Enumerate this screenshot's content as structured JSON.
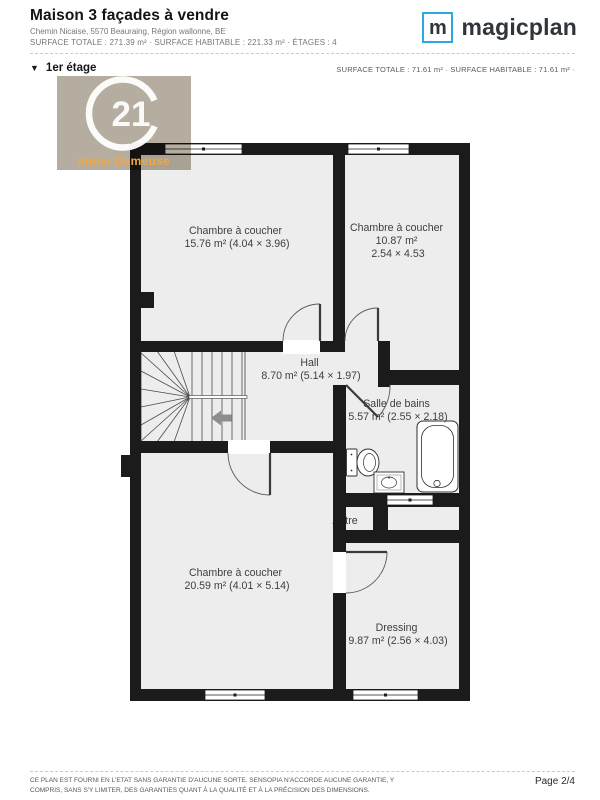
{
  "header": {
    "title": "Maison 3 façades à vendre",
    "address": "Chemin Nicaise, 5570 Beauraing, Région wallonne, BE",
    "surfaces": "SURFACE TOTALE : 271.39 m² · SURFACE HABITABLE : 221.33 m² · ÉTAGES : 4",
    "logo_letter": "m",
    "logo_text": "magicplan",
    "brand_color": "#2aaae1"
  },
  "section": {
    "collapse_icon": "▼",
    "floor": "1er étage",
    "surfaces": "SURFACE TOTALE : 71.61 m² · SURFACE HABITABLE : 71.61 m² ·"
  },
  "watermark": {
    "number": "21",
    "agency": "Immo Demeuse",
    "bg_color": "#b5ad9f",
    "text_color": "#f4a63f"
  },
  "rooms": {
    "bedroom_top_left": {
      "name": "Chambre à coucher",
      "area_dims": "15.76 m² (4.04 × 3.96)"
    },
    "bedroom_top_right": {
      "name": "Chambre à coucher",
      "area": "10.87 m²",
      "dims": "2.54 × 4.53"
    },
    "hall": {
      "name": "Hall",
      "area_dims": "8.70 m² (5.14 × 1.97)"
    },
    "bathroom": {
      "name": "Salle de bains",
      "area_dims": "5.57 m² (2.55 × 2.18)"
    },
    "bedroom_bottom_left": {
      "name": "Chambre à coucher",
      "area_dims": "20.59 m² (4.01 × 5.14)"
    },
    "dressing": {
      "name": "Dressing",
      "area_dims": "9.87 m² (2.56 × 4.03)"
    },
    "other": {
      "name": "Autre"
    }
  },
  "colors": {
    "wall": "#1b1b1b",
    "floor": "#ededed",
    "label": "#3e3e3e"
  },
  "footer": {
    "disclaimer1": "CE PLAN EST FOURNI EN L'ETAT SANS GARANTIE D'AUCUNE SORTE. SENSOPIA N'ACCORDE AUCUNE GARANTIE, Y",
    "disclaimer2": "COMPRIS, SANS S'Y LIMITER, DES GARANTIES QUANT À LA QUALITÉ ET À LA PRÉCISION DES DIMENSIONS.",
    "page_number": "Page 2/4"
  }
}
